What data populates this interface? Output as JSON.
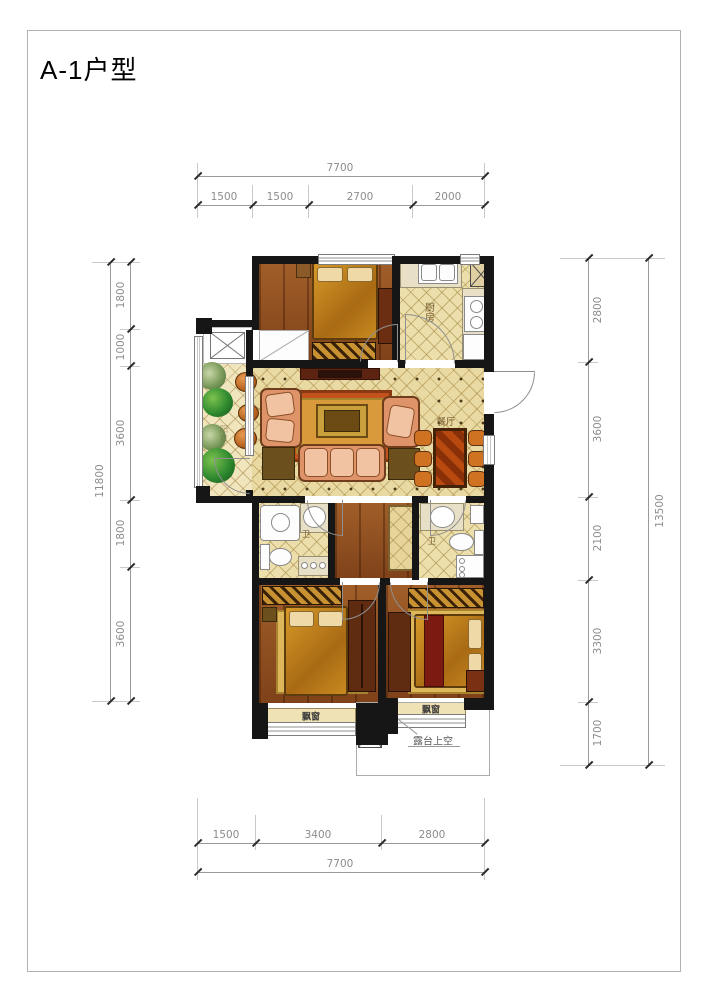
{
  "title": "A-1户型",
  "dims": {
    "top": {
      "total": "7700",
      "segments": [
        "1500",
        "1500",
        "2700",
        "2000"
      ]
    },
    "bottom": {
      "total": "7700",
      "segments": [
        "1500",
        "3400",
        "2800"
      ]
    },
    "left": {
      "total": "11800",
      "segments": [
        "1800",
        "1000",
        "3600",
        "1800",
        "3600"
      ]
    },
    "right": {
      "total": "13500",
      "segments": [
        "2800",
        "3600",
        "2100",
        "3300",
        "1700"
      ]
    }
  },
  "rooms": {
    "kitchen": "厨房",
    "dining": "餐厅",
    "bath1": "卫",
    "bath2": "卫",
    "balcony": "阳台",
    "bay_left": "飘窗",
    "bay_right": "飘窗",
    "terrace": "露台上空"
  },
  "colors": {
    "wall": "#161616",
    "dimension_lines": "#9a9a9a",
    "tile_floor": "#ecdfab",
    "wood_floor": "#8c4b1e",
    "sofa": "#de9468",
    "dining_table": "#b84a10",
    "bedding": "#c88a20",
    "plant": "#2f8a2f",
    "rug": "#c2531e"
  }
}
